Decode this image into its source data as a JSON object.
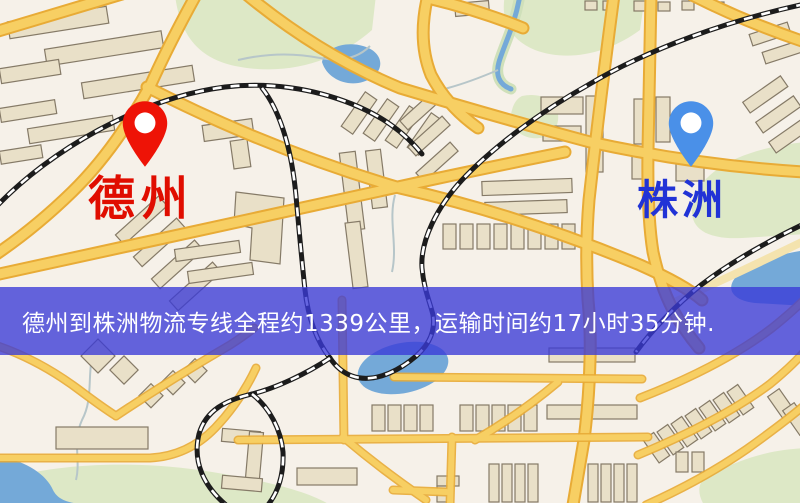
{
  "banner": {
    "text": "德州到株洲物流专线全程约1339公里，运输时间约17小时35分钟.",
    "background": "rgba(58,58,215,0.78)",
    "text_color": "#ffffff"
  },
  "markers": {
    "origin": {
      "label": "德州",
      "pin_color": "#ee1306",
      "label_color": "#e00d00"
    },
    "destination": {
      "label": "株洲",
      "pin_color": "#4a90e8",
      "label_color": "#2133d6"
    }
  },
  "map": {
    "colors": {
      "background": "#f6f1e9",
      "park": "#dde8c6",
      "water": "#74a9d8",
      "building": "#e9e0c8",
      "road": "#f7cf63",
      "road_casing": "#e8ab36",
      "railway": "#1c1c1c"
    }
  }
}
